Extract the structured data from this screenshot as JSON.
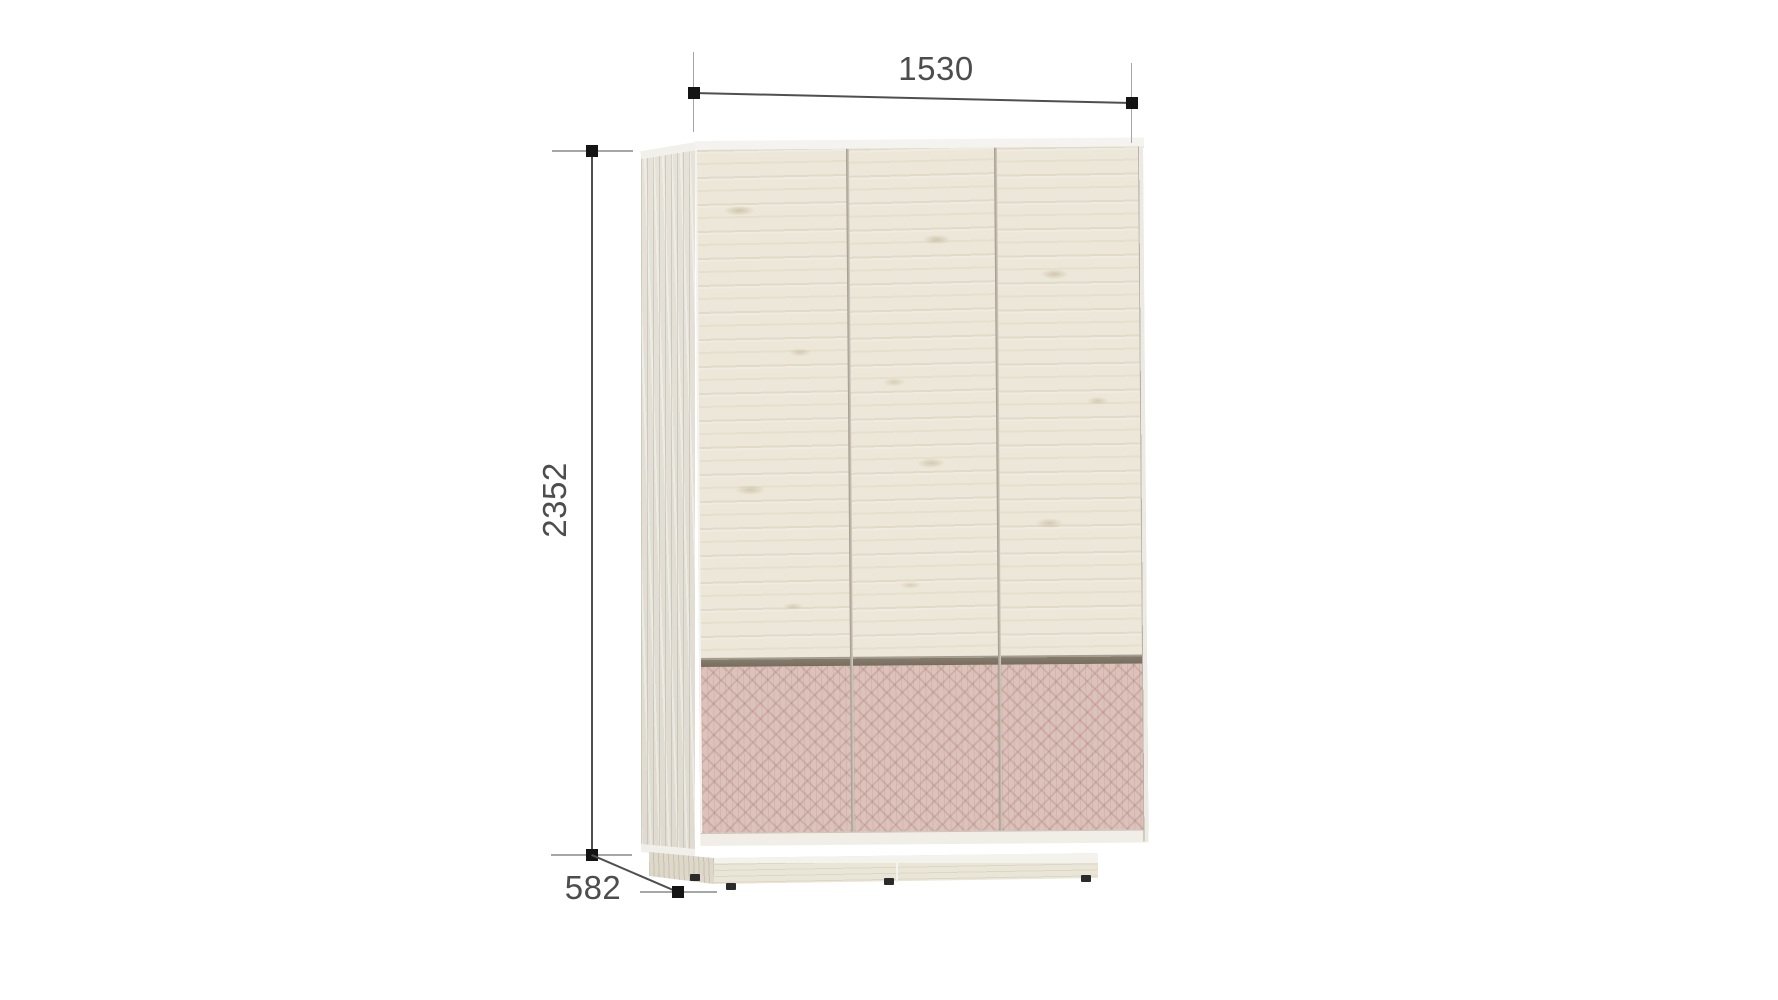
{
  "diagram": {
    "subject": "three-door wardrobe with patterned lower drawer panels on a plinth base",
    "dimensions": {
      "width": "1530",
      "height": "2352",
      "depth": "582"
    },
    "colors": {
      "background": "#ffffff",
      "door_wood": "#ece7d8",
      "side_panel_wood": "#e2ded5",
      "drawer_pink": "#dcc2bb",
      "drawer_pattern_line": "#94645c",
      "separator_groove": "#847b6d",
      "edge_band": "#f2f0ea",
      "plinth_wood": "#e9e5d7",
      "foot": "#2b2b2b",
      "dimension_line": "#4f4f4f",
      "extension_line": "#a6a6a6",
      "marker": "#141414",
      "label_text": "#4d4d4d"
    }
  }
}
